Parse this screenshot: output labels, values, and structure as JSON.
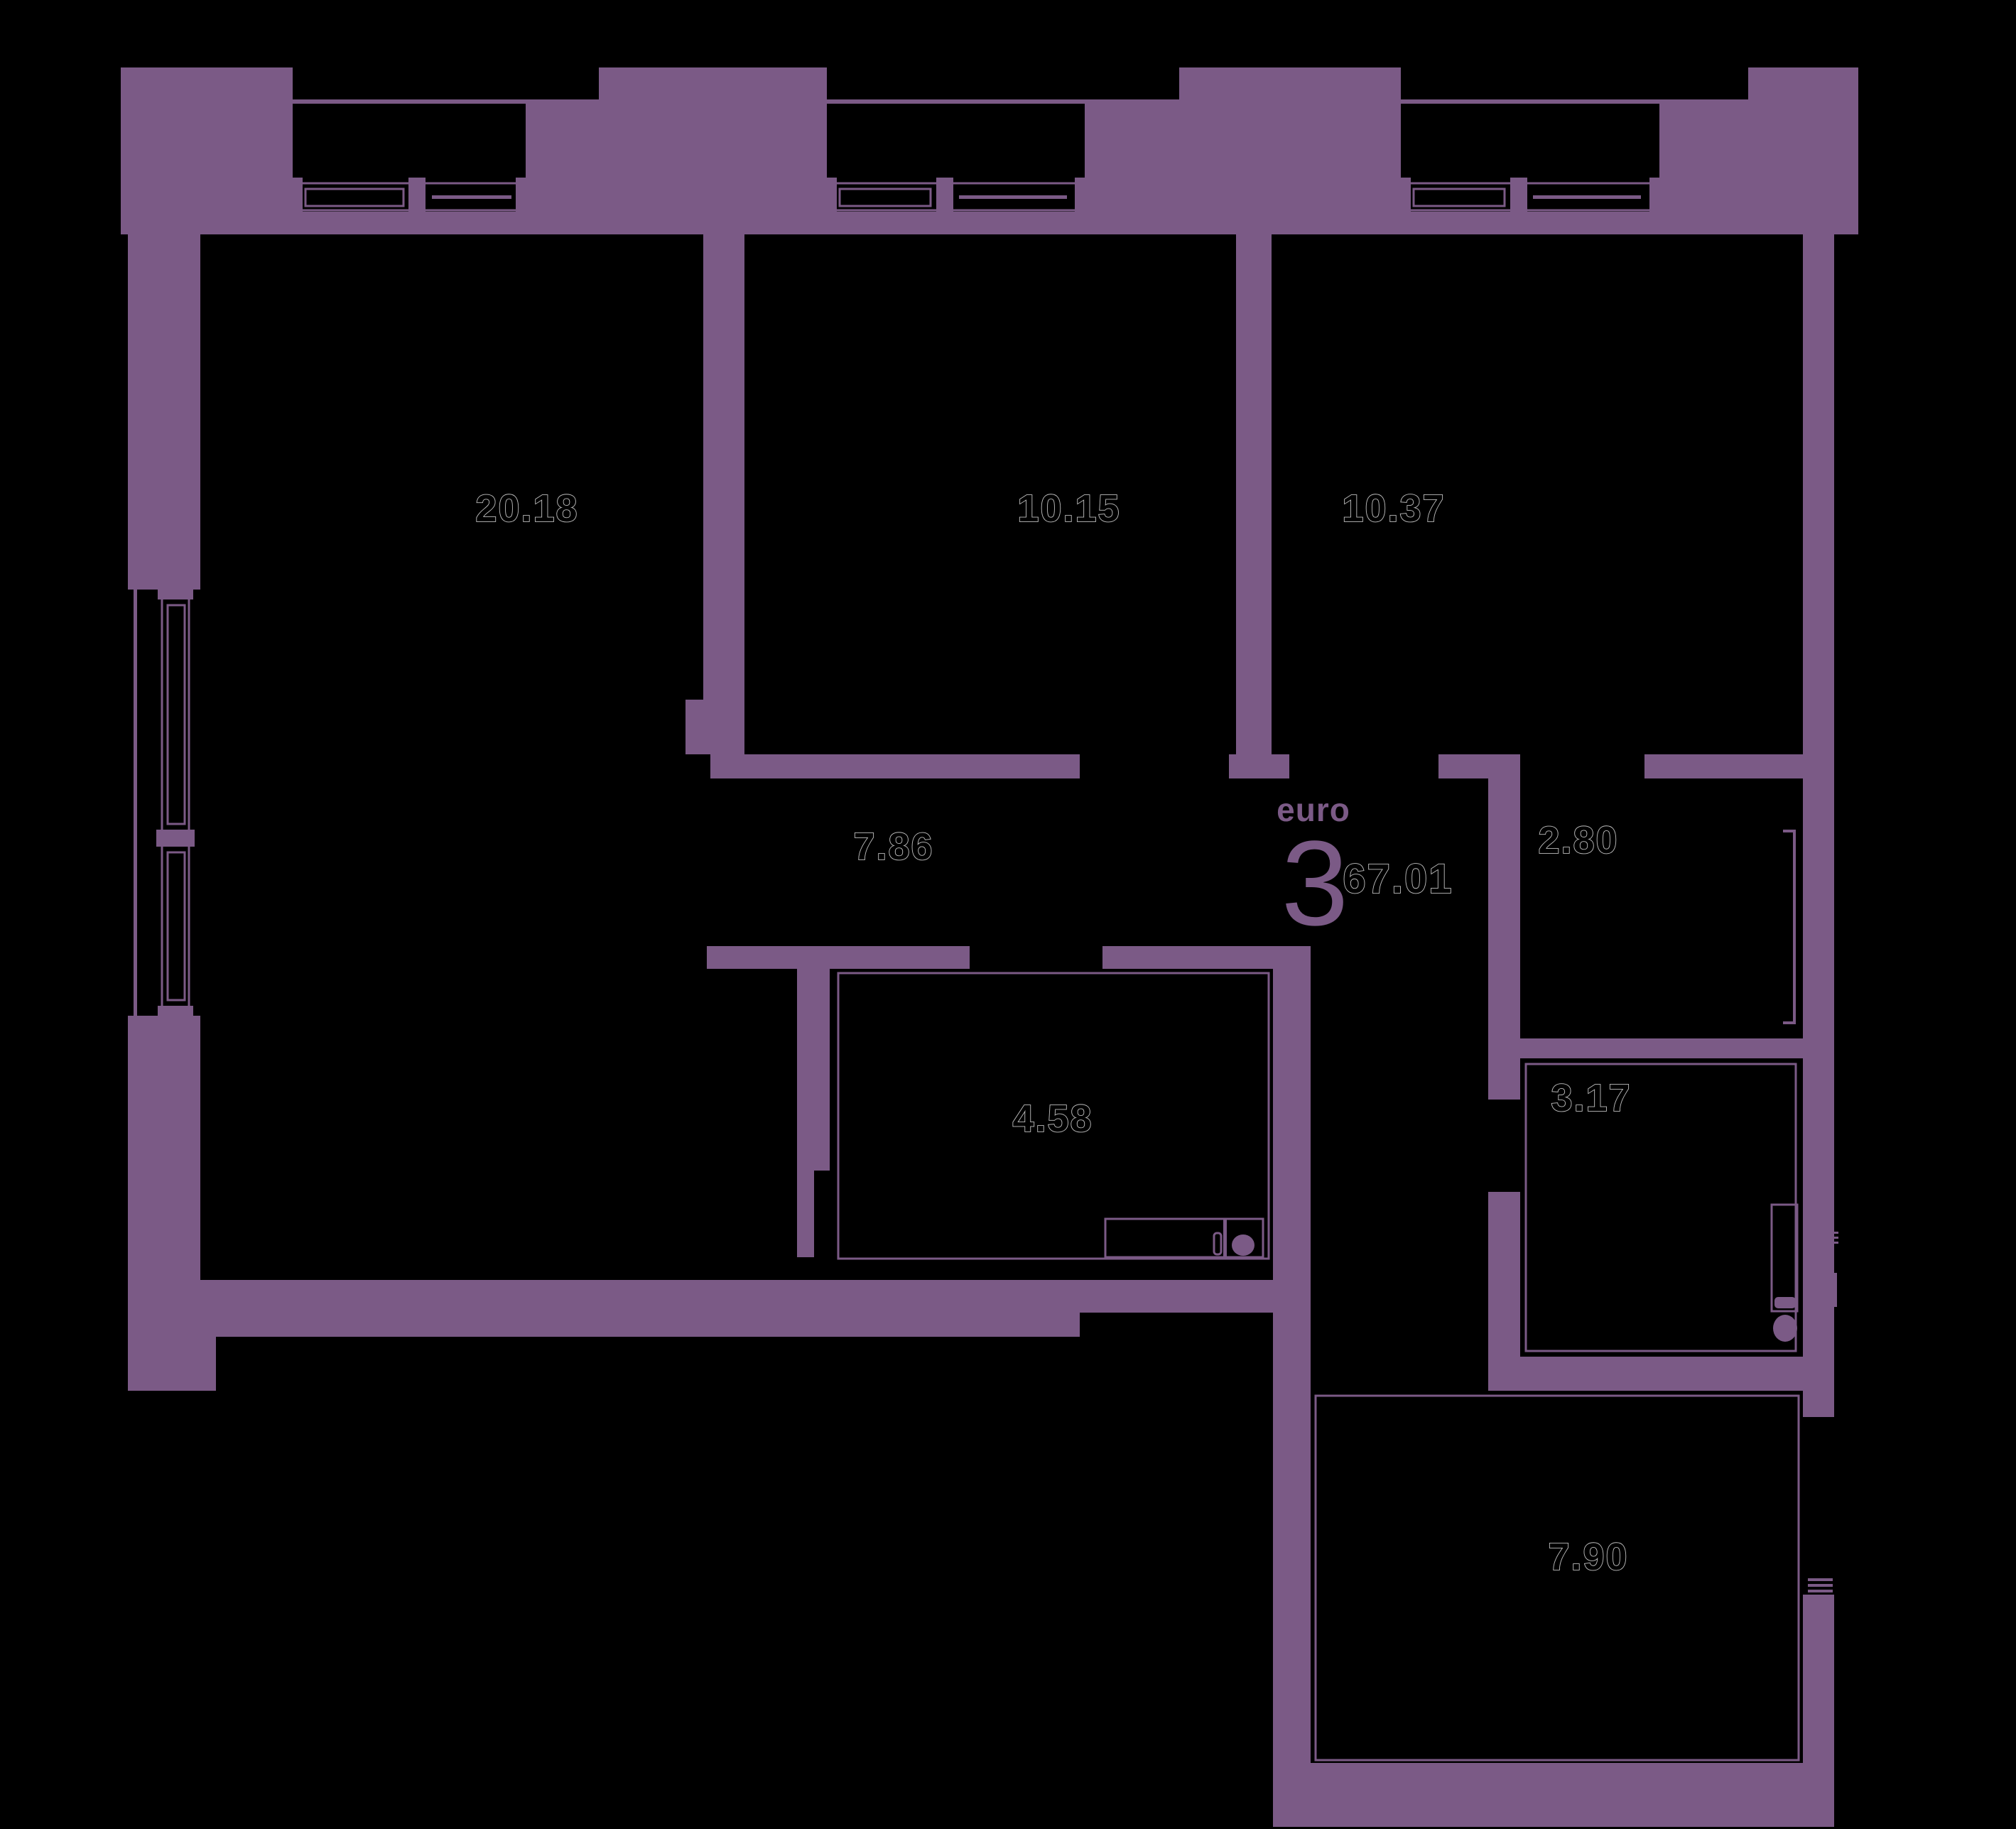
{
  "plan": {
    "title": "apartment-floor-plan",
    "type_label": "euro",
    "type_number": "3",
    "total_area": "67.01",
    "rooms": [
      {
        "name": "living-room",
        "area": "20.18"
      },
      {
        "name": "bedroom-1",
        "area": "10.15"
      },
      {
        "name": "bedroom-2",
        "area": "10.37"
      },
      {
        "name": "hallway",
        "area": "7.86"
      },
      {
        "name": "wardrobe",
        "area": "2.80"
      },
      {
        "name": "kitchen",
        "area": "4.58"
      },
      {
        "name": "bathroom",
        "area": "3.17"
      },
      {
        "name": "balcony",
        "area": "7.90"
      }
    ],
    "colors": {
      "background": "#000000",
      "wall": "#7B5A86",
      "label_fill": "#000000",
      "label_outline": "#BEBEBE",
      "accent_text": "#7B5A86"
    }
  }
}
